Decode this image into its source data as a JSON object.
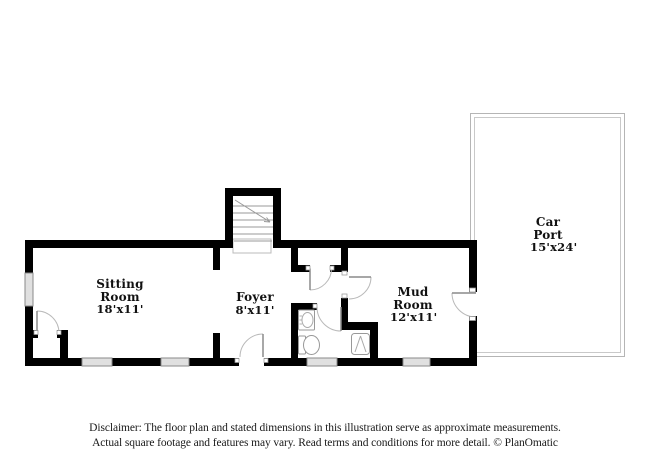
{
  "floor_plan": {
    "rooms": [
      {
        "name": "Sitting Room",
        "dimensions": "18'x11'"
      },
      {
        "name": "Foyer",
        "dimensions": "8'x11'"
      },
      {
        "name": "Mud Room",
        "dimensions": "12'x11'"
      },
      {
        "name": "Car Port",
        "dimensions": "15'x24'"
      }
    ],
    "fixtures": [
      "stairs-icon",
      "sink-icon",
      "toilet-icon",
      "water-heater-icon",
      "door-arc-icon",
      "window-icon"
    ],
    "colors": {
      "wall": "#000000",
      "door_arc": "#b9b9b9",
      "door_leaf": "#8a8a8a",
      "window_fill": "#e0e0e0",
      "window_stroke": "#8a8a8a",
      "carport_outline": "#b5b5b5",
      "stair_tread": "#999999",
      "text": "#111111"
    }
  },
  "disclaimer": {
    "line1": "Disclaimer: The floor plan and stated dimensions in this illustration serve as approximate measurements.",
    "line2": "Actual square footage and features may vary. Read terms and conditions for more detail. © PlanOmatic"
  }
}
